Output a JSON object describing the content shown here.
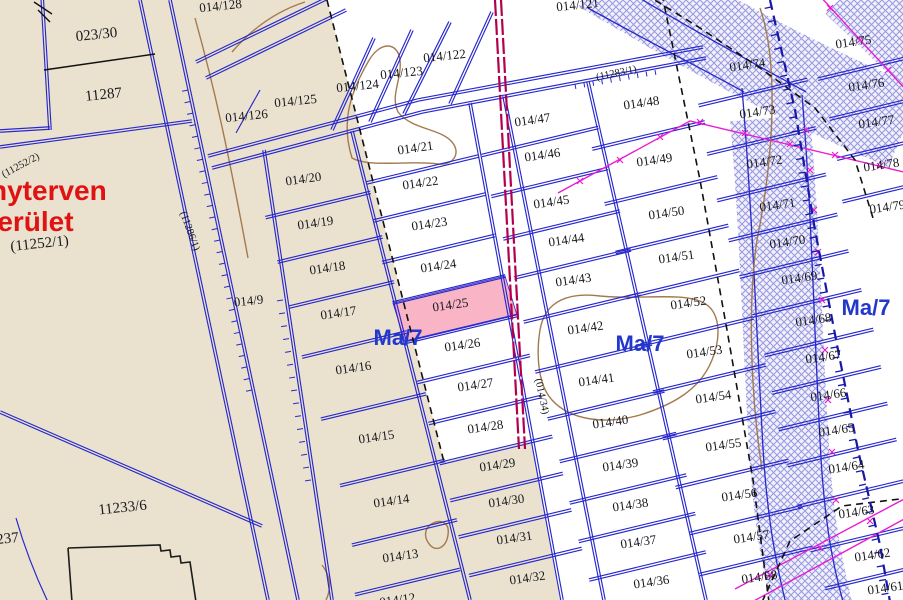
{
  "map": {
    "selected_parcel": "014/25",
    "zone_code": "Ma/7",
    "colors": {
      "paper_beige": "#eae2cf",
      "parcel_white": "#ffffff",
      "line_blue": "#2828cc",
      "label_ink": "#18181e",
      "red_text": "#e01212",
      "zone_blue": "#2238cc",
      "selected_pink": "#f9b4c6",
      "crimson_line": "#b2004e",
      "magenta_line": "#ea1cd4",
      "hatch_line": "#8585da",
      "hatch_bg": "#efeefb",
      "contour_brown": "#a37a4e",
      "dashed_black": "#111111",
      "toothed_blue": "#1818a8",
      "building_black": "#1b1b1b"
    },
    "red_labels": [
      {
        "t": "nyterven",
        "x": -10,
        "y": 200
      },
      {
        "t": "terület",
        "x": -12,
        "y": 231
      }
    ],
    "zone_labels": [
      {
        "t": "Ma/7",
        "x": 398,
        "y": 345
      },
      {
        "t": "Ma/7",
        "x": 640,
        "y": 351
      },
      {
        "t": "Ma/7",
        "x": 866,
        "y": 315
      }
    ],
    "rotated_labels": [
      {
        "t": "(11252/2)",
        "x": 22,
        "y": 168,
        "r": -28
      },
      {
        "t": "(11286/1)",
        "x": 187,
        "y": 232,
        "r": 70
      },
      {
        "t": "(11283/1)",
        "x": 617,
        "y": 76,
        "r": -12
      },
      {
        "t": "(014/34)",
        "x": 539,
        "y": 397,
        "r": 78
      }
    ],
    "loose_parcels": [
      {
        "t": "023/30",
        "x": 97,
        "y": 39,
        "s": 15
      },
      {
        "t": "11287",
        "x": 104,
        "y": 99,
        "s": 15
      },
      {
        "t": "(11252/1)",
        "x": 40,
        "y": 248,
        "s": 15
      },
      {
        "t": "11233/6",
        "x": 123,
        "y": 512,
        "s": 15
      },
      {
        "t": "237",
        "x": 8,
        "y": 543,
        "s": 15
      },
      {
        "t": "014/128",
        "x": 221,
        "y": 10
      },
      {
        "t": "014/126",
        "x": 247,
        "y": 120
      },
      {
        "t": "014/125",
        "x": 296,
        "y": 105
      },
      {
        "t": "014/124",
        "x": 358,
        "y": 90
      },
      {
        "t": "014/123",
        "x": 402,
        "y": 77
      },
      {
        "t": "014/122",
        "x": 445,
        "y": 60
      },
      {
        "t": "014/121",
        "x": 578,
        "y": 9
      },
      {
        "t": "014/9",
        "x": 249,
        "y": 305
      }
    ],
    "parcel_columns": [
      {
        "halfwidth": 54,
        "dx": 8,
        "parcels": [
          {
            "t": "014/20",
            "x": 304,
            "y": 183
          },
          {
            "t": "014/19",
            "x": 316,
            "y": 227
          },
          {
            "t": "014/18",
            "x": 328,
            "y": 272
          },
          {
            "t": "014/17",
            "x": 339,
            "y": 317
          },
          {
            "t": "014/16",
            "x": 354,
            "y": 372
          },
          {
            "t": "014/15",
            "x": 377,
            "y": 441
          },
          {
            "t": "014/14",
            "x": 392,
            "y": 505
          },
          {
            "t": "014/13",
            "x": 401,
            "y": 560
          },
          {
            "t": "014/12",
            "x": 398,
            "y": 604
          }
        ]
      },
      {
        "halfwidth": 58,
        "dx": 4,
        "parcels": [
          {
            "t": "014/21",
            "x": 416,
            "y": 152
          },
          {
            "t": "014/22",
            "x": 421,
            "y": 187
          },
          {
            "t": "014/23",
            "x": 430,
            "y": 228
          },
          {
            "t": "014/24",
            "x": 439,
            "y": 270
          },
          {
            "t": "014/25",
            "x": 451,
            "y": 309
          },
          {
            "t": "014/26",
            "x": 463,
            "y": 349
          },
          {
            "t": "014/27",
            "x": 476,
            "y": 389
          },
          {
            "t": "014/28",
            "x": 486,
            "y": 431
          },
          {
            "t": "014/29",
            "x": 498,
            "y": 469
          },
          {
            "t": "014/30",
            "x": 507,
            "y": 505
          },
          {
            "t": "014/31",
            "x": 515,
            "y": 542
          },
          {
            "t": "014/32",
            "x": 528,
            "y": 582
          }
        ]
      },
      {
        "halfwidth": 60,
        "dx": 2,
        "parcels": [
          {
            "t": "014/47",
            "x": 533,
            "y": 124
          },
          {
            "t": "014/46",
            "x": 543,
            "y": 159
          },
          {
            "t": "014/45",
            "x": 552,
            "y": 206
          },
          {
            "t": "014/44",
            "x": 567,
            "y": 244
          },
          {
            "t": "014/43",
            "x": 574,
            "y": 284
          },
          {
            "t": "014/42",
            "x": 586,
            "y": 332
          },
          {
            "t": "014/41",
            "x": 597,
            "y": 384
          },
          {
            "t": "014/40",
            "x": 611,
            "y": 426
          },
          {
            "t": "014/39",
            "x": 621,
            "y": 469
          },
          {
            "t": "014/38",
            "x": 631,
            "y": 509
          },
          {
            "t": "014/37",
            "x": 639,
            "y": 546
          },
          {
            "t": "014/36",
            "x": 652,
            "y": 586
          }
        ]
      },
      {
        "halfwidth": 58,
        "dx": 0,
        "parcels": [
          {
            "t": "014/48",
            "x": 642,
            "y": 107
          },
          {
            "t": "014/49",
            "x": 655,
            "y": 164
          },
          {
            "t": "014/50",
            "x": 667,
            "y": 217
          },
          {
            "t": "014/51",
            "x": 677,
            "y": 261
          },
          {
            "t": "014/52",
            "x": 689,
            "y": 307
          },
          {
            "t": "014/53",
            "x": 705,
            "y": 356
          },
          {
            "t": "014/54",
            "x": 714,
            "y": 401
          },
          {
            "t": "014/55",
            "x": 724,
            "y": 449
          },
          {
            "t": "014/56",
            "x": 740,
            "y": 499
          },
          {
            "t": "014/57",
            "x": 752,
            "y": 541
          },
          {
            "t": "014/58",
            "x": 760,
            "y": 581
          }
        ]
      },
      {
        "halfwidth": 56,
        "dx": 0,
        "parcels": [
          {
            "t": "014/74",
            "x": 748,
            "y": 69
          },
          {
            "t": "014/73",
            "x": 758,
            "y": 116
          },
          {
            "t": "014/72",
            "x": 765,
            "y": 166
          },
          {
            "t": "014/71",
            "x": 778,
            "y": 209
          },
          {
            "t": "014/70",
            "x": 788,
            "y": 246
          },
          {
            "t": "014/69",
            "x": 800,
            "y": 282
          },
          {
            "t": "014/68",
            "x": 814,
            "y": 324
          },
          {
            "t": "014/67",
            "x": 824,
            "y": 361
          },
          {
            "t": "014/66",
            "x": 829,
            "y": 399
          },
          {
            "t": "014/65",
            "x": 837,
            "y": 434
          },
          {
            "t": "014/64",
            "x": 847,
            "y": 471
          },
          {
            "t": "014/63",
            "x": 857,
            "y": 516
          },
          {
            "t": "014/62",
            "x": 873,
            "y": 559
          },
          {
            "t": "014/61",
            "x": 886,
            "y": 592
          }
        ]
      },
      {
        "halfwidth": 50,
        "dx": 6,
        "parcels": [
          {
            "t": "014/75",
            "x": 854,
            "y": 46
          },
          {
            "t": "014/76",
            "x": 867,
            "y": 89
          },
          {
            "t": "014/77",
            "x": 877,
            "y": 126
          },
          {
            "t": "014/78",
            "x": 882,
            "y": 169
          },
          {
            "t": "014/79",
            "x": 888,
            "y": 211
          }
        ]
      }
    ]
  }
}
